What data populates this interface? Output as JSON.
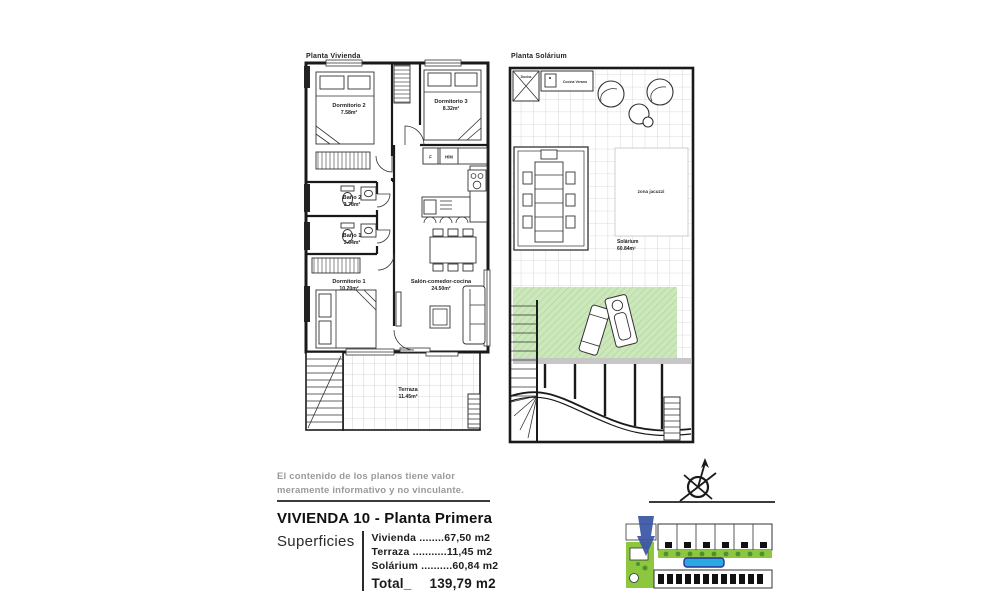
{
  "canvas": {
    "width": 1001,
    "height": 606,
    "background": "#ffffff"
  },
  "plans": {
    "vivienda": {
      "title": "Planta Vivienda",
      "rooms": [
        {
          "name": "Dormitorio 2",
          "area": "7.58m²"
        },
        {
          "name": "Dormitorio 3",
          "area": "8.32m²"
        },
        {
          "name": "Baño 2",
          "area": "3.78m²"
        },
        {
          "name": "Baño 1",
          "area": "3.64m²"
        },
        {
          "name": "Dormitorio 1",
          "area": "10.20m²"
        },
        {
          "name": "Salón-comedor-cocina",
          "area": "24.50m²"
        },
        {
          "name": "Terraza",
          "area": "11.45m²"
        }
      ],
      "appliances": {
        "fridge": "F",
        "oven_micro": "H/M"
      }
    },
    "solarium": {
      "title": "Planta Solárium",
      "shower": "Ducha",
      "summer_kitchen": "Cocina Verano",
      "jacuzzi_zone": "zona jacuzzi",
      "room_name": "Solárium",
      "room_area": "60.84m²"
    }
  },
  "disclaimer": {
    "line1": "El contenido de los planos tiene valor",
    "line2": "meramente informativo y no vinculante."
  },
  "title_block": {
    "title": "VIVIENDA 10 - Planta Primera",
    "surfaces_label": "Superficies",
    "rows": [
      {
        "label": "Vivienda ",
        "dots": "........",
        "value": "67,50 m2"
      },
      {
        "label": "Terraza ",
        "dots": "...........",
        "value": "11,45 m2"
      },
      {
        "label": "Solárium ",
        "dots": "..........",
        "value": "60,84 m2"
      }
    ],
    "total_label": "Total_",
    "total_value": "139,79 m2"
  },
  "colors": {
    "solarium_green": "#cde7bd",
    "solarium_hatch": "#a9d694",
    "siteplan_green": "#8dc63f",
    "siteplan_blue": "#3953a4",
    "pool_blue": "#27aae1",
    "disclaimer_gray": "#9a9a9a"
  }
}
